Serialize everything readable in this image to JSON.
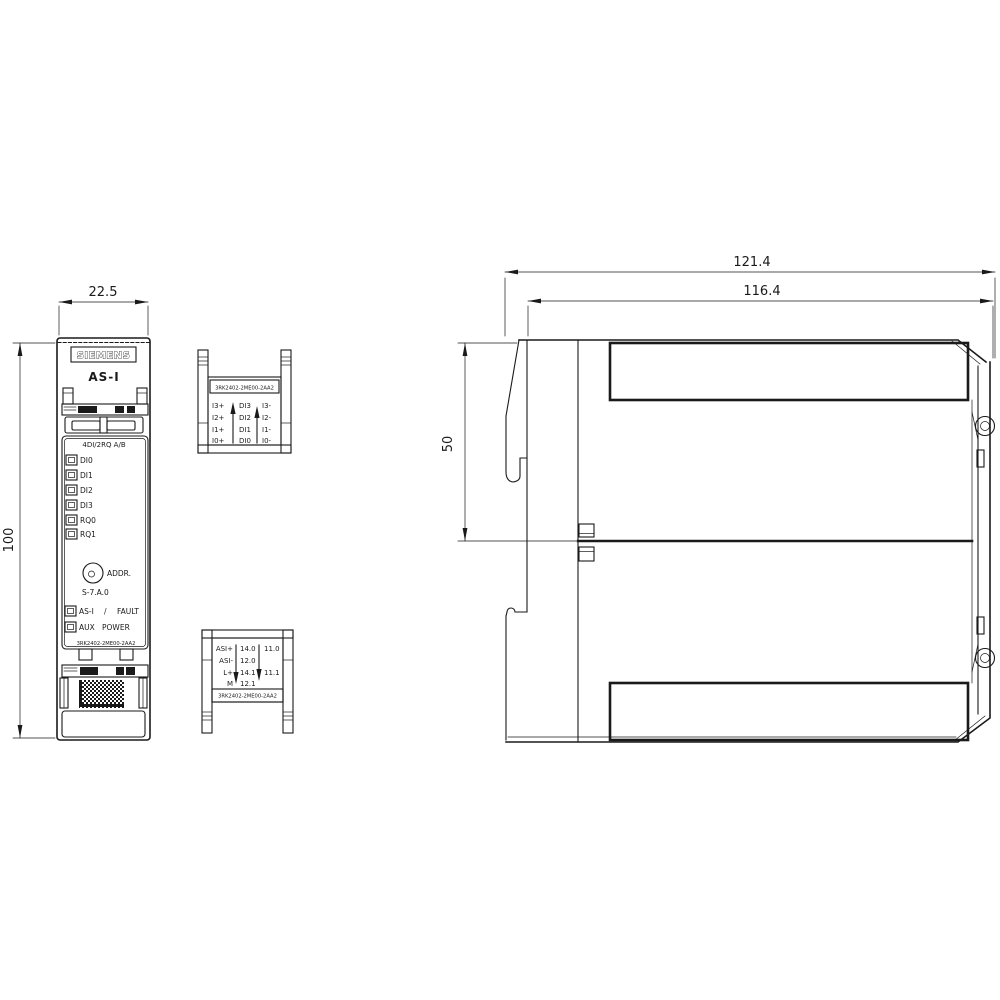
{
  "drawing": {
    "brand": "SIEMENS",
    "product_family": "AS-I",
    "module_type": "4DI/2RQ A/B",
    "part_number": "3RK2402-2ME00-2AA2",
    "dimensions": {
      "front_width_mm": "22.5",
      "front_height_mm": "100",
      "side_overall_mm": "121.4",
      "side_body_mm": "116.4",
      "side_upper_mm": "50"
    },
    "front_view": {
      "io_leds": [
        "DI0",
        "DI1",
        "DI2",
        "DI3",
        "RQ0",
        "RQ1"
      ],
      "addr_label": "ADDR.",
      "addr_range": "S-7.A.0",
      "status1_name": "AS-I",
      "status1_sep": "/",
      "status1_value": "FAULT",
      "status2_name": "AUX",
      "status2_value": "POWER"
    },
    "top_terminal": {
      "col1": [
        "I3+",
        "I2+",
        "I1+",
        "I0+"
      ],
      "col2": [
        "DI3",
        "DI2",
        "DI1",
        "DI0"
      ],
      "col3": [
        "I3-",
        "I2-",
        "I1-",
        "I0-"
      ]
    },
    "bottom_terminal": {
      "col1": [
        "ASI+",
        "ASI-",
        "L+",
        "M"
      ],
      "col2": [
        "14.0",
        "12.0",
        "14.1",
        "12.1"
      ],
      "col3": [
        "11.0",
        "11.1"
      ]
    },
    "colors": {
      "line": "#1a1a1a",
      "background": "#ffffff"
    }
  }
}
